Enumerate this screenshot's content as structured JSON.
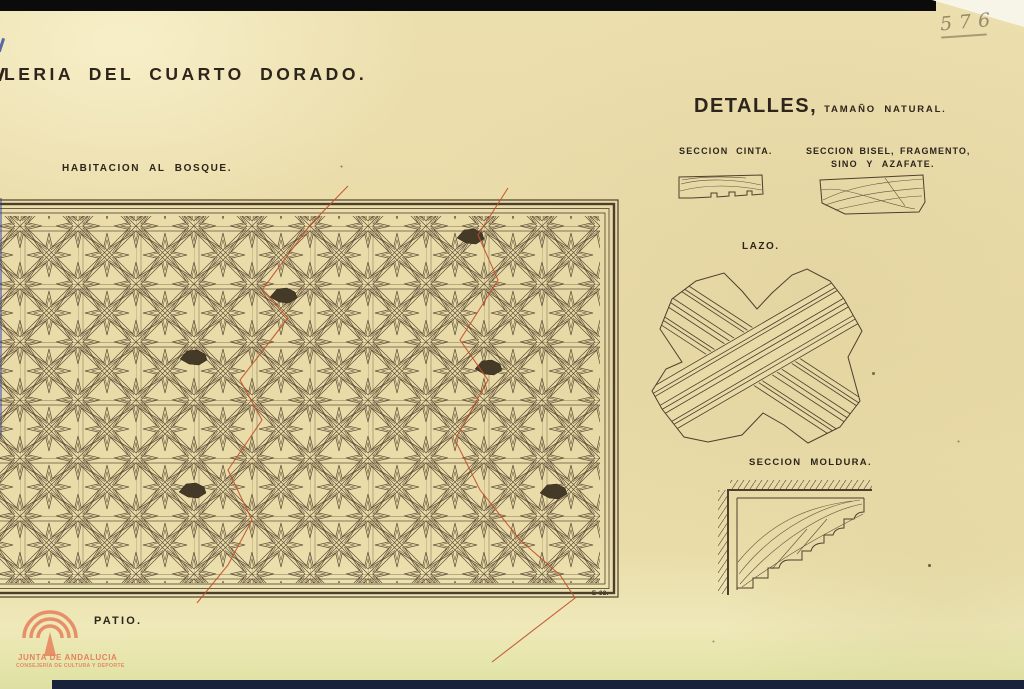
{
  "sheet": {
    "title": "LERIA DEL CUARTO DORADO.",
    "number_pencil": "576",
    "plate_mark": "E-32."
  },
  "panel": {
    "label": "HABITACION AL BOSQUE.",
    "bottom_label": "PATIO."
  },
  "details": {
    "heading": "DETALLES,",
    "heading_suffix": "TAMAÑO NATURAL.",
    "section_cinta": "SECCION CINTA.",
    "section_bisel_line1": "SECCION BISEL, FRAGMENTO,",
    "section_bisel_line2": "SINO Y AZAFATE.",
    "lazo": "LAZO.",
    "section_moldura": "SECCION MOLDURA."
  },
  "stamp": {
    "line1": "JUNTA DE ANDALUCIA",
    "line2": "CONSEJERÍA DE CULTURA Y DEPORTE"
  },
  "colors": {
    "paper": "#e8dba8",
    "text": "#2d251b",
    "ink": "#4c3f2c",
    "ink_light": "#63523a",
    "red": "#c14f2d",
    "logo": "#e5815c",
    "pencil": "#96896a",
    "bar_top": "#0b0b0c",
    "bar_bottom": "#18223a"
  }
}
